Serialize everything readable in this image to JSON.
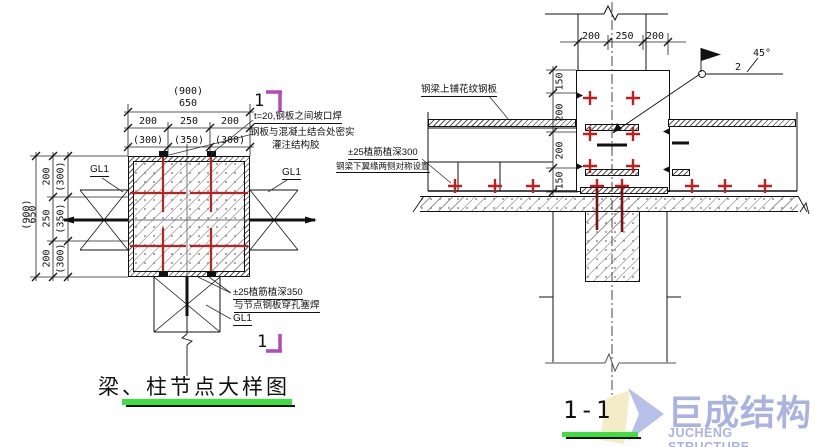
{
  "left": {
    "dim_900": "(900)",
    "dim_650": "650",
    "dims_a": [
      "200",
      "250",
      "200"
    ],
    "dims_b": [
      "(300)",
      "(350)",
      "(300)"
    ],
    "gl1": "GL1",
    "weld_note_1": "t=20,钢板之间坡口焊",
    "weld_note_2": "钢板与混凝土结合处密实",
    "weld_note_3": "灌注结构胶",
    "rebar_note_1": "±25植筋植深350",
    "rebar_note_2": "与节点钢板穿孔塞焊",
    "rebar_note_3": "GL1",
    "section_no": "1",
    "title": "梁、柱节点大样图"
  },
  "right": {
    "dims_top": [
      "200",
      "250",
      "200"
    ],
    "dims_side": [
      "150",
      "200",
      "200",
      "150"
    ],
    "plate_note": "钢梁上铺花纹钢板",
    "rebar_note_1": "±25植筋植深300",
    "rebar_note_2": "钢梁下翼缘两侧对称设置",
    "weld_size": "2",
    "weld_angle": "45°",
    "section_label": "1-1"
  },
  "logo": {
    "cn": "巨成结构",
    "en": "JUCHENG STRUCTURE"
  },
  "colors": {
    "red": "#c22020",
    "dark_red": "#7a1414",
    "magenta": "#b44ab4",
    "green": "#3fdf3f",
    "logo_blue": "#a9b3e2",
    "logo_yellow": "#f3ecc6"
  }
}
